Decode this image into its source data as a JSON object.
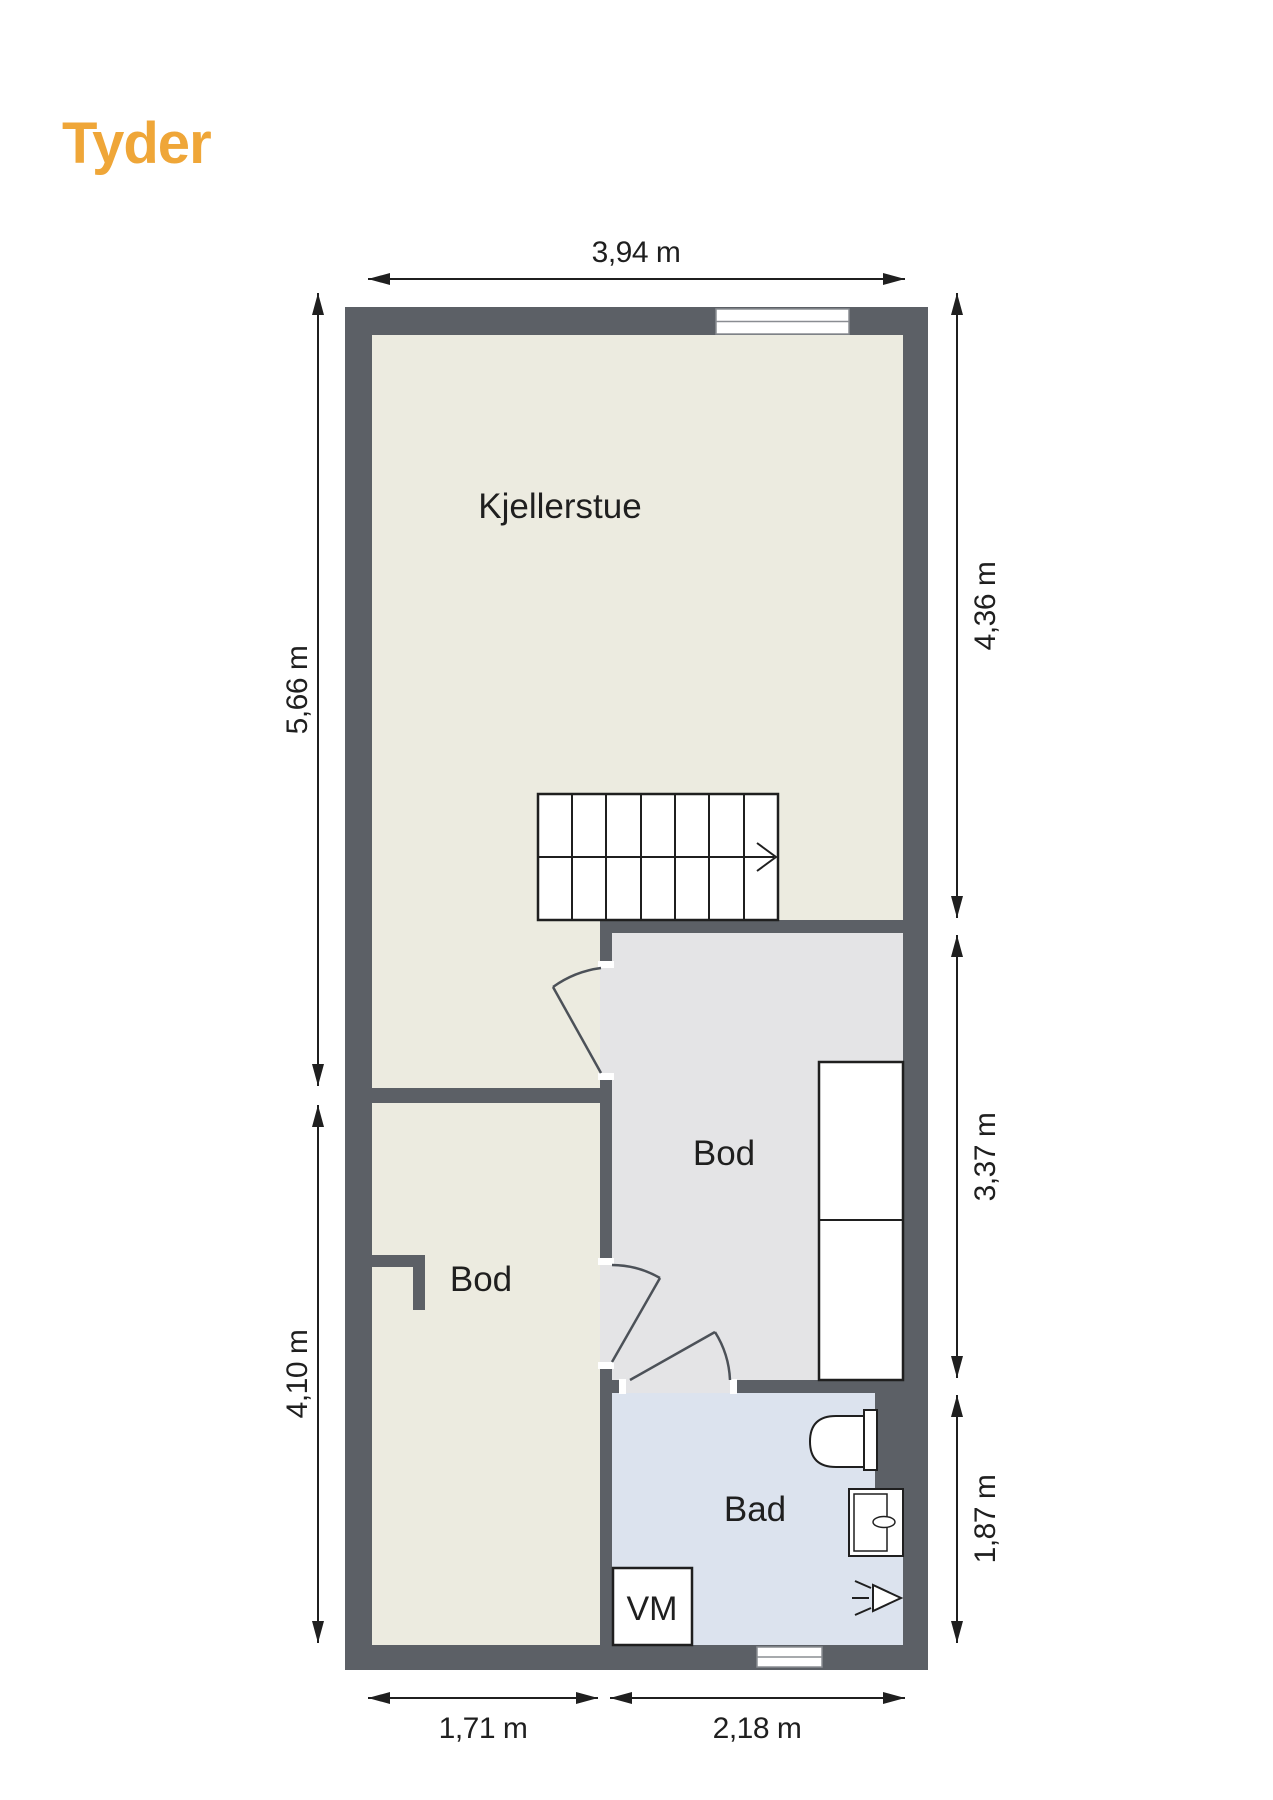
{
  "brand": {
    "logo_text": "Tyder",
    "logo_color": "#EFA638"
  },
  "floorplan": {
    "rooms": {
      "kjellerstue": {
        "label": "Kjellerstue"
      },
      "bod_right": {
        "label": "Bod"
      },
      "bod_left": {
        "label": "Bod"
      },
      "bad": {
        "label": "Bad"
      }
    },
    "appliances": {
      "washing_machine": {
        "label": "VM"
      }
    },
    "dimensions": {
      "top": {
        "label": "3,94 m"
      },
      "left_upper": {
        "label": "5,66 m"
      },
      "left_lower": {
        "label": "4,10 m"
      },
      "right_upper": {
        "label": "4,36 m"
      },
      "right_middle": {
        "label": "3,37 m"
      },
      "right_lower": {
        "label": "1,87 m"
      },
      "bottom_left": {
        "label": "1,71 m"
      },
      "bottom_right": {
        "label": "2,18 m"
      }
    },
    "colors": {
      "wall": "#5C6066",
      "floor_kjellerstue": "#ECEBE0",
      "floor_bod_right": "#E4E4E6",
      "floor_bod_left": "#ECEBE0",
      "floor_bad": "#DCE3EE"
    },
    "fixtures": [
      "stairs-icon",
      "toilet-icon",
      "sink-icon",
      "shower-icon",
      "window-icon",
      "door-icon"
    ]
  }
}
